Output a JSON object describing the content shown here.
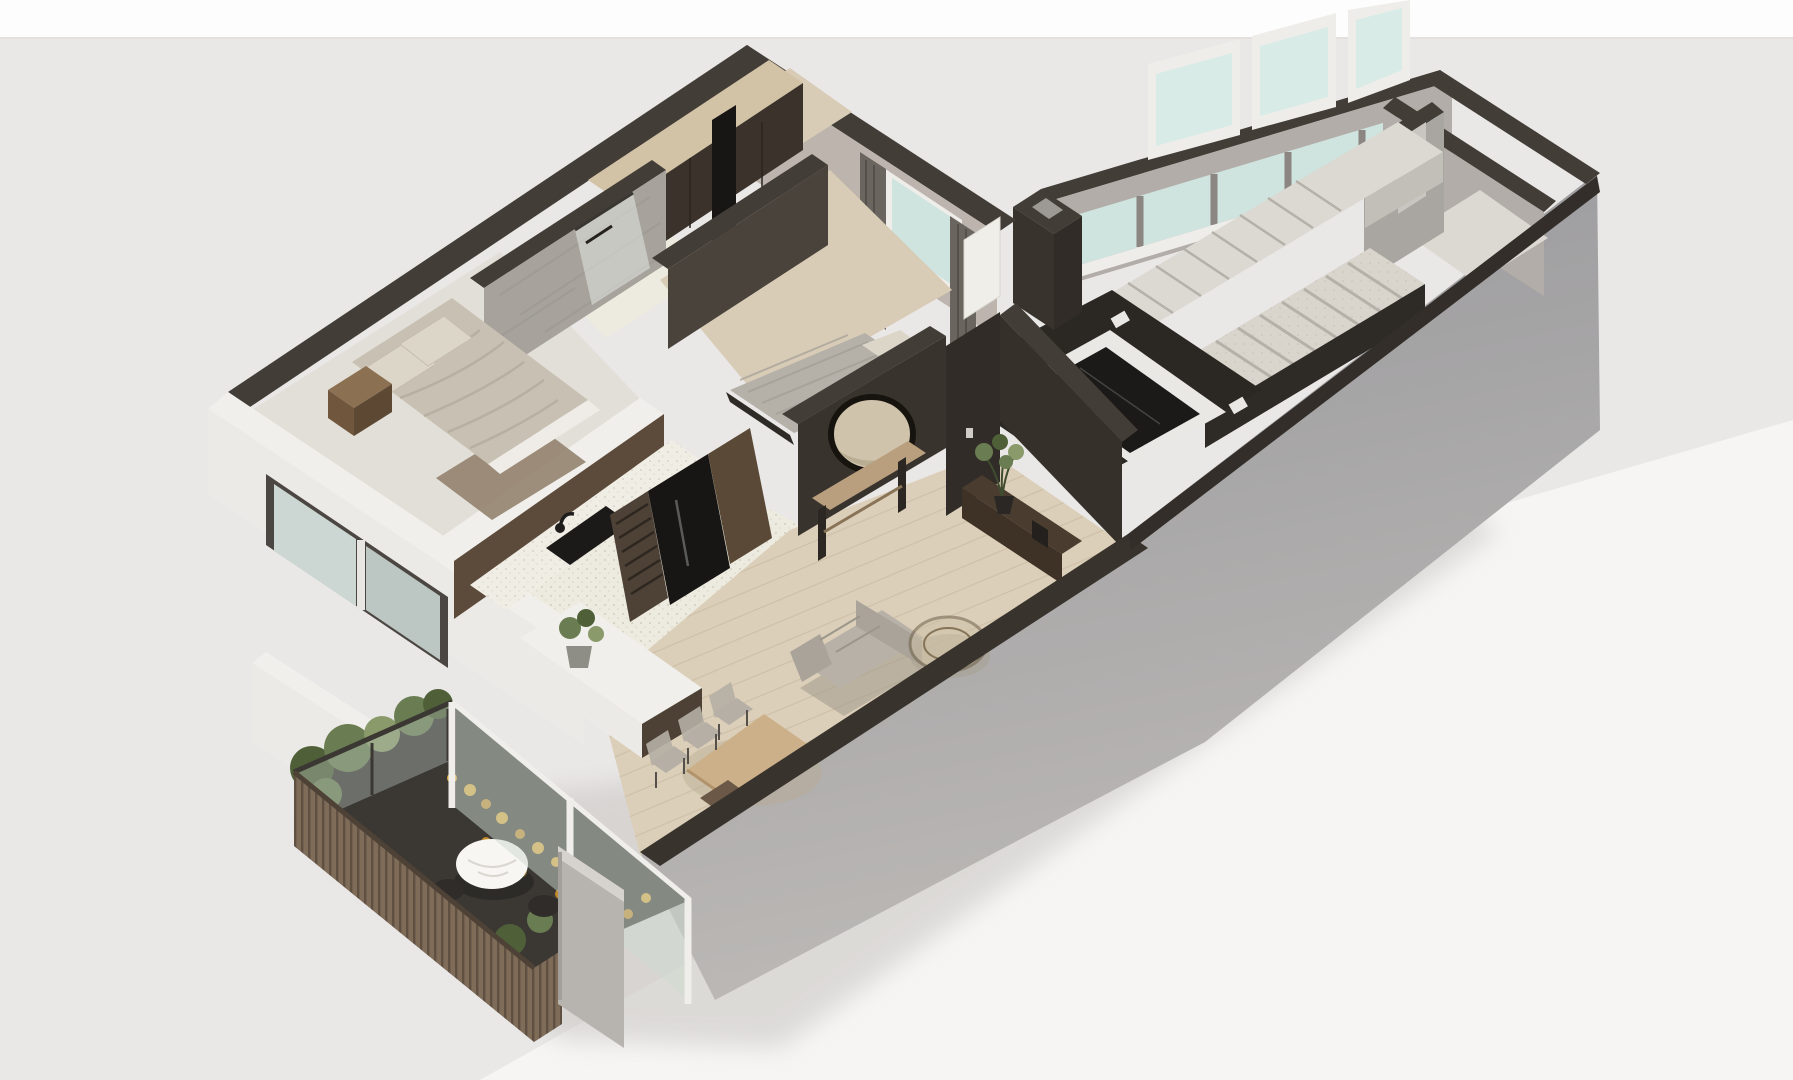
{
  "scene": {
    "type": "isometric-3d-floor-plan-render",
    "description": "Cutaway axonometric render of a one-bedroom-plus-den apartment with stair hall wing and planted balcony terrace",
    "rooms": [
      {
        "name": "entry-hall-wardrobe"
      },
      {
        "name": "bathroom"
      },
      {
        "name": "master-bedroom"
      },
      {
        "name": "second-bedroom"
      },
      {
        "name": "kitchen"
      },
      {
        "name": "living-dining-room"
      },
      {
        "name": "balcony-terrace"
      },
      {
        "name": "stair-hall"
      },
      {
        "name": "stair-landing-room"
      }
    ],
    "furniture": [
      "double-bed",
      "nightstand",
      "area-rug",
      "wardrobe-row",
      "shower-glass",
      "kitchen-counter",
      "cooktop",
      "fridge",
      "wine-rack",
      "kitchen-island",
      "island-plant",
      "guest-bed",
      "round-mirror",
      "console-bench",
      "dining-table",
      "dining-chairs",
      "sofa",
      "round-coffee-table",
      "tv-console",
      "console-plant",
      "outdoor-round-table",
      "outdoor-chairs",
      "terrace-planting",
      "glass-balustrade",
      "wood-slat-fence",
      "switchback-staircase",
      "floor-skylight"
    ]
  },
  "colors": {
    "bg": "#eae8e7",
    "top_strip": "#fdfdfd",
    "strip_line": "#e3e1e0",
    "white_wedge": "#f6f5f4",
    "shadow": "#c8c5c1",
    "slab_top": "#96969a",
    "slab_bottom": "#bcb9b6",
    "wall_top": "#433d37",
    "wall_top_dark": "#332e29",
    "wall_face": "#bdb5ad",
    "wall_face2": "#b2ada8",
    "wall_gray": "#a9a5a0",
    "white_wall": "#f1efeb",
    "white_soft": "#eceae6",
    "concrete": "#a7a39c",
    "wood_cap": "#d2c3a6",
    "dark_wood": "#3b332b",
    "black_panel": "#181614",
    "floor_light": "#e2dfd8",
    "floor_wood": "#d9ccb7",
    "floor_wood2": "#dccfb9",
    "plank_line": "#c9bba2",
    "tile": "#edebdf",
    "glass": "#ccd6d2",
    "glass_teal": "#cfe3df",
    "glass_frame": "#4b4641",
    "white_frame": "#efede9",
    "curtain": "#6b6560",
    "dark_wall": "#38332d",
    "dark_wall2": "#4a433c",
    "entry_wall": "#312c28",
    "living_wall": "#36302b",
    "mirror_face": "#cfc3ab",
    "mirror_rim": "#17130f",
    "console_wood": "#b99f7e",
    "cabinet_dark": "#5c4a3a",
    "counter": "#f0ede5",
    "cooktop": "#1b1a19",
    "wine_rack": "#4e4236",
    "fridge": "#171615",
    "wood_panel": "#5b4937",
    "island_base": "#4d4135",
    "bed_blanket": "#c8c1b3",
    "pillow": "#dcd6c9",
    "bed2_blanket": "#b5b0a8",
    "rug": "#8e7c67",
    "nightstand": "#8c7052",
    "nightstand_side": "#6f563d",
    "sofa": "#b7b1a7",
    "sofa_dark": "#a9a399",
    "table_wood": "#ccb089",
    "chair": "#b5afa5",
    "stool": "#6b5846",
    "tv_wood": "#4a3d30",
    "tv_front": "#3e3226",
    "plant_green": "#6a7d52",
    "plant_dark": "#4f6039",
    "plant_light": "#8a9a6a",
    "deck": "#3b3834",
    "flower_yellow": "#d9a93e",
    "flower_orange": "#c08a2a",
    "slat": "#7e6b58",
    "slat_line": "#5f5042",
    "stub_wall": "#b7b4b0",
    "stair_tread": "#d9d4cc",
    "stair_riser": "#b5b0a8",
    "stair_stringer": "#2e2a26",
    "landing": "#dcd8d2",
    "sky_frame": "#eae8e4",
    "sky_glass": "#1c1a18",
    "sky_floor": "#2b2824",
    "door_white": "#f0eee9"
  }
}
